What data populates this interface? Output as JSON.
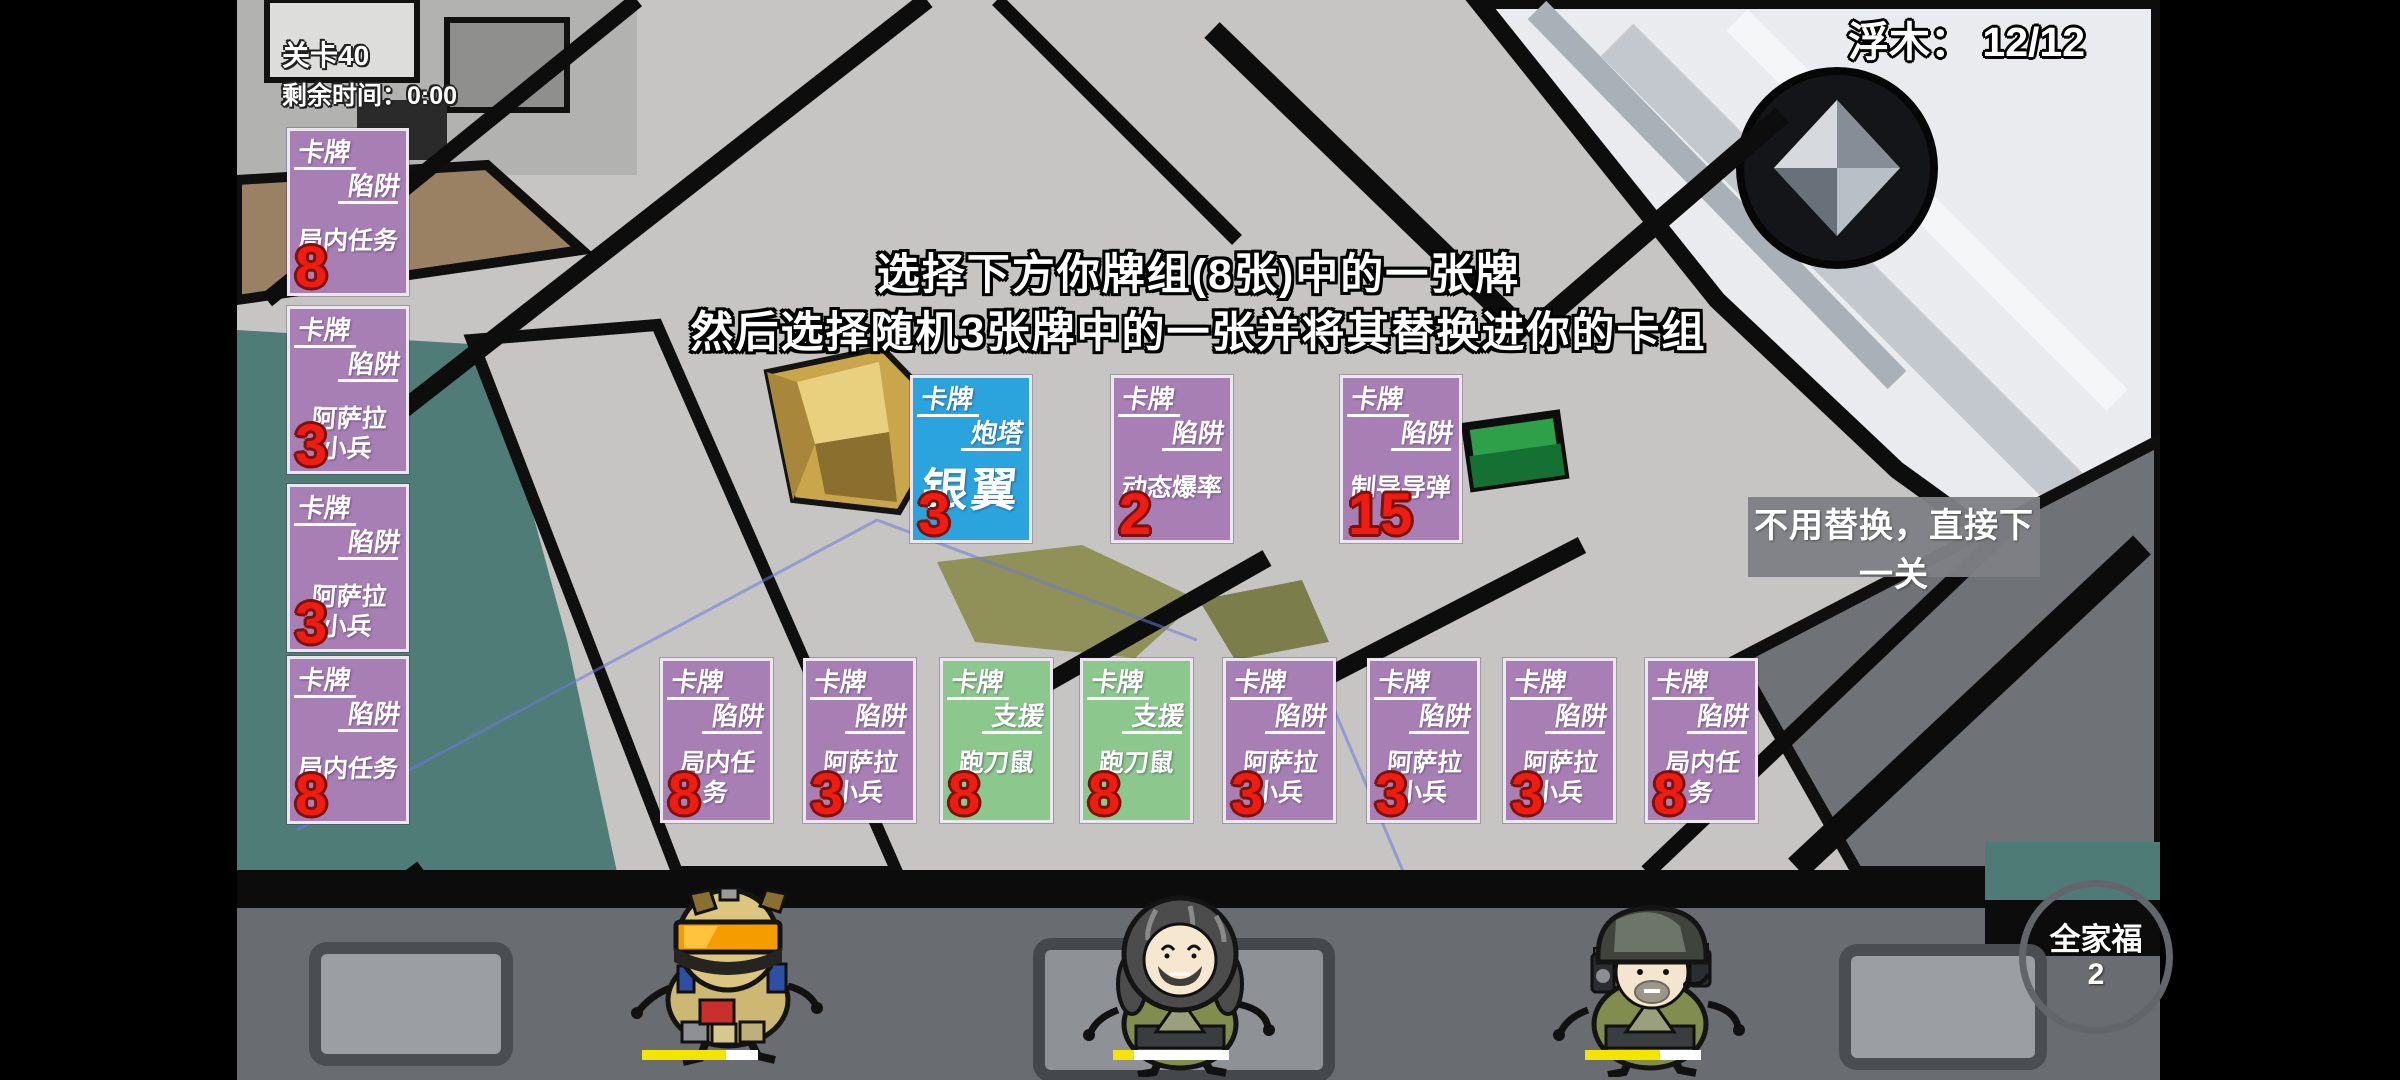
{
  "hud": {
    "level": "关卡40",
    "time": "剩余时间：0:00",
    "driftwood_label": "浮木：",
    "driftwood_value": "12/12",
    "family_label": "全家福",
    "family_count": "2"
  },
  "instruction": {
    "line1": "选择下方你牌组(8张)中的一张牌",
    "line2": "然后选择随机3张牌中的一张并将其替换进你的卡组"
  },
  "skip_button_label": "不用替换，直接下一关",
  "colors": {
    "card_purple": "#a77fb5",
    "card_green": "#8cc78d",
    "card_blue": "#2ba3dc",
    "cost_red": "#ee1c11",
    "health_yellow": "#f2e500"
  },
  "left_cards": [
    {
      "header": "卡牌",
      "type": "陷阱",
      "name": "局内任务",
      "name2": "",
      "cost": "8",
      "color": "#a77fb5"
    },
    {
      "header": "卡牌",
      "type": "陷阱",
      "name": "阿萨拉",
      "name2": "小兵",
      "cost": "3",
      "color": "#a77fb5"
    },
    {
      "header": "卡牌",
      "type": "陷阱",
      "name": "阿萨拉",
      "name2": "小兵",
      "cost": "3",
      "color": "#a77fb5"
    },
    {
      "header": "卡牌",
      "type": "陷阱",
      "name": "局内任务",
      "name2": "",
      "cost": "8",
      "color": "#a77fb5"
    }
  ],
  "choice_cards": [
    {
      "header": "卡牌",
      "type": "炮塔",
      "name": "银翼",
      "name2": "",
      "cost": "3",
      "color": "#2ba3dc"
    },
    {
      "header": "卡牌",
      "type": "陷阱",
      "name": "动态爆率",
      "name2": "",
      "cost": "2",
      "color": "#a77fb5"
    },
    {
      "header": "卡牌",
      "type": "陷阱",
      "name": "制导导弹",
      "name2": "",
      "cost": "15",
      "color": "#a77fb5"
    }
  ],
  "deck_cards": [
    {
      "header": "卡牌",
      "type": "陷阱",
      "name": "局内任务",
      "name2": "",
      "cost": "8",
      "color": "#a77fb5"
    },
    {
      "header": "卡牌",
      "type": "陷阱",
      "name": "阿萨拉",
      "name2": "小兵",
      "cost": "3",
      "color": "#a77fb5"
    },
    {
      "header": "卡牌",
      "type": "支援",
      "name": "跑刀鼠",
      "name2": "",
      "cost": "8",
      "color": "#8cc78d"
    },
    {
      "header": "卡牌",
      "type": "支援",
      "name": "跑刀鼠",
      "name2": "",
      "cost": "8",
      "color": "#8cc78d"
    },
    {
      "header": "卡牌",
      "type": "陷阱",
      "name": "阿萨拉",
      "name2": "小兵",
      "cost": "3",
      "color": "#a77fb5"
    },
    {
      "header": "卡牌",
      "type": "陷阱",
      "name": "阿萨拉",
      "name2": "小兵",
      "cost": "3",
      "color": "#a77fb5"
    },
    {
      "header": "卡牌",
      "type": "陷阱",
      "name": "阿萨拉",
      "name2": "小兵",
      "cost": "3",
      "color": "#a77fb5"
    },
    {
      "header": "卡牌",
      "type": "陷阱",
      "name": "局内任务",
      "name2": "",
      "cost": "8",
      "color": "#a77fb5"
    }
  ],
  "characters": [
    {
      "name": "visor-soldier",
      "health_fill": "72%",
      "bar_color": "#f2e500"
    },
    {
      "name": "long-hair-soldier",
      "health_fill": "18%",
      "bar_color": "#f2e500"
    },
    {
      "name": "helmet-headset-soldier",
      "health_fill": "65%",
      "bar_color": "#f2e500"
    }
  ]
}
